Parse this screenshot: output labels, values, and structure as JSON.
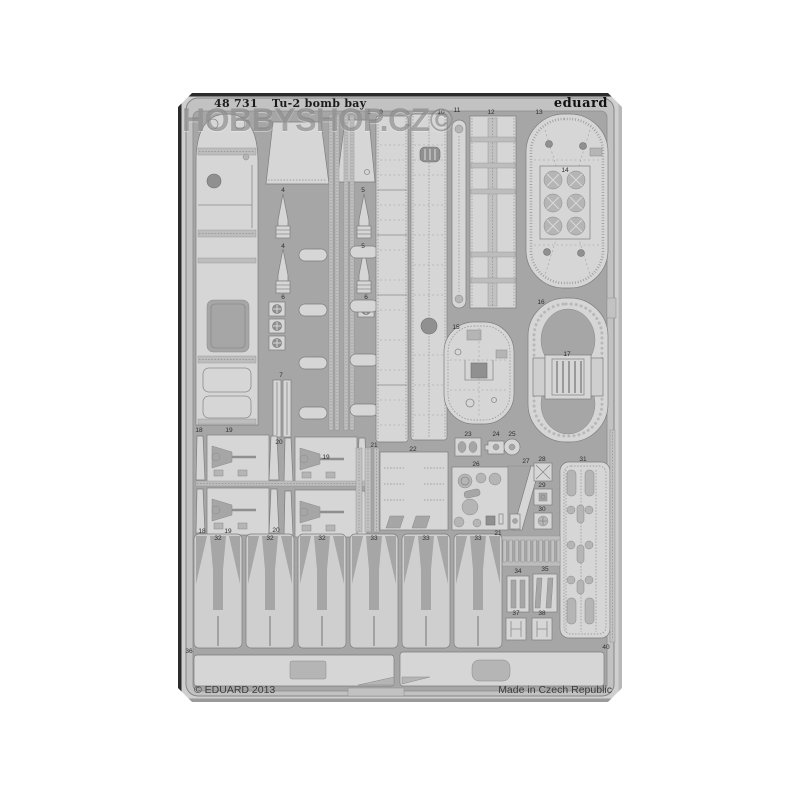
{
  "product_photo": {
    "header": {
      "catalog_number": "48 731",
      "product_title": "Tu-2 bomb bay",
      "brand_logo": "eduard"
    },
    "watermark_text": "HOBBYSHOP.CZ©",
    "footer": {
      "copyright_text": "© EDUARD 2013",
      "origin_text": "Made in Czech Republic"
    },
    "colors": {
      "photo_background": "#cfcfcf",
      "fret_background": "#a6a6a6",
      "fret_frame": "#c2c2c2",
      "part_fill": "#d6d6d6",
      "part_outline": "#7e7e7e",
      "detail_dark": "#909090",
      "header_text": "#1b1b1b",
      "watermark": "rgba(108,108,108,0.52)"
    },
    "part_labels": [
      {
        "n": "1",
        "x": 369,
        "y": 114
      },
      {
        "n": "9",
        "x": 381,
        "y": 114
      },
      {
        "n": "10",
        "x": 441,
        "y": 114
      },
      {
        "n": "11",
        "x": 457,
        "y": 112
      },
      {
        "n": "12",
        "x": 491,
        "y": 114
      },
      {
        "n": "13",
        "x": 539,
        "y": 114
      },
      {
        "n": "14",
        "x": 565,
        "y": 172
      },
      {
        "n": "4",
        "x": 283,
        "y": 192
      },
      {
        "n": "5",
        "x": 363,
        "y": 192
      },
      {
        "n": "4",
        "x": 283,
        "y": 248
      },
      {
        "n": "5",
        "x": 363,
        "y": 248
      },
      {
        "n": "6",
        "x": 283,
        "y": 299
      },
      {
        "n": "6",
        "x": 366,
        "y": 299
      },
      {
        "n": "7",
        "x": 281,
        "y": 377
      },
      {
        "n": "15",
        "x": 456,
        "y": 329
      },
      {
        "n": "16",
        "x": 541,
        "y": 304
      },
      {
        "n": "17",
        "x": 567,
        "y": 356
      },
      {
        "n": "18",
        "x": 199,
        "y": 432
      },
      {
        "n": "19",
        "x": 229,
        "y": 432
      },
      {
        "n": "20",
        "x": 279,
        "y": 444
      },
      {
        "n": "19",
        "x": 326,
        "y": 459
      },
      {
        "n": "21",
        "x": 374,
        "y": 447
      },
      {
        "n": "22",
        "x": 413,
        "y": 451
      },
      {
        "n": "23",
        "x": 468,
        "y": 436
      },
      {
        "n": "24",
        "x": 496,
        "y": 436
      },
      {
        "n": "25",
        "x": 512,
        "y": 436
      },
      {
        "n": "26",
        "x": 476,
        "y": 466
      },
      {
        "n": "27",
        "x": 526,
        "y": 463
      },
      {
        "n": "28",
        "x": 542,
        "y": 461
      },
      {
        "n": "29",
        "x": 542,
        "y": 487
      },
      {
        "n": "30",
        "x": 542,
        "y": 511
      },
      {
        "n": "31",
        "x": 583,
        "y": 461
      },
      {
        "n": "20",
        "x": 276,
        "y": 532
      },
      {
        "n": "18",
        "x": 202,
        "y": 533
      },
      {
        "n": "19",
        "x": 228,
        "y": 533
      },
      {
        "n": "21",
        "x": 498,
        "y": 535
      },
      {
        "n": "32",
        "x": 218,
        "y": 540
      },
      {
        "n": "32",
        "x": 270,
        "y": 540
      },
      {
        "n": "32",
        "x": 322,
        "y": 540
      },
      {
        "n": "33",
        "x": 374,
        "y": 540
      },
      {
        "n": "33",
        "x": 426,
        "y": 540
      },
      {
        "n": "33",
        "x": 478,
        "y": 540
      },
      {
        "n": "34",
        "x": 518,
        "y": 573
      },
      {
        "n": "35",
        "x": 545,
        "y": 571
      },
      {
        "n": "37",
        "x": 516,
        "y": 615
      },
      {
        "n": "38",
        "x": 542,
        "y": 615
      },
      {
        "n": "36",
        "x": 189,
        "y": 653
      },
      {
        "n": "40",
        "x": 606,
        "y": 649
      }
    ]
  }
}
